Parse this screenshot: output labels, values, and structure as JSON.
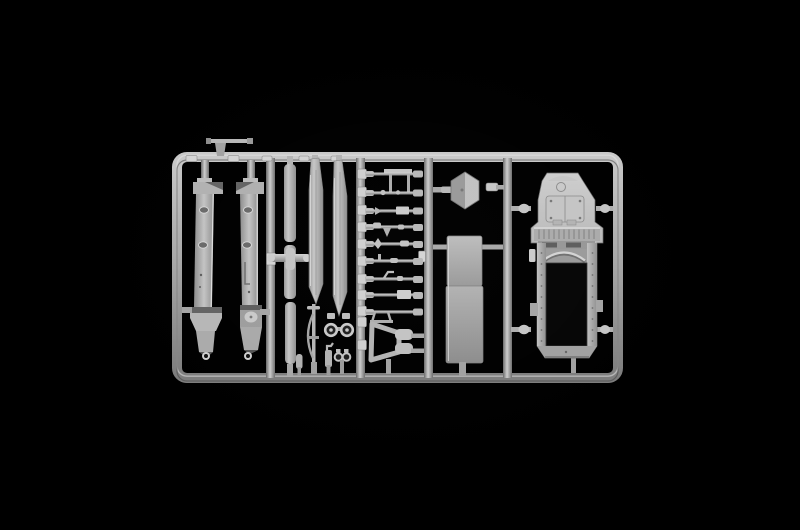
{
  "scene": {
    "type": "photograph",
    "subject": "Light gray injection-molded plastic model kit sprue (parts tree) for a military truck, photographed on a black background",
    "background": "#000000",
    "colors": {
      "plastic-light": "#d8d8d8",
      "plastic-mid": "#a9a9a9",
      "plastic-dark": "#6f6f6f",
      "plastic-shadow": "#4e4e4e",
      "hole": "#060606"
    }
  },
  "sprue": {
    "frame": "rounded rectangular outer runner with four internal vertical runners and molded part-number tabs",
    "parts": [
      {
        "id": "chassis-rail-left",
        "desc": "long chassis side rail with two oval lightening holes and fender foot"
      },
      {
        "id": "chassis-rail-right",
        "desc": "long chassis side rail with filler block, round cap and fender foot"
      },
      {
        "id": "exhaust-pipe",
        "desc": "three-segment tubular exhaust with center collar and crossbar"
      },
      {
        "id": "bed-panel-left",
        "desc": "long tapered side panel"
      },
      {
        "id": "bed-panel-right",
        "desc": "long tapered side panel"
      },
      {
        "id": "bow-stand",
        "desc": "thin lever with bowed brace"
      },
      {
        "id": "steering-wheels",
        "desc": "pair of small wheels with hubs"
      },
      {
        "id": "small-fittings",
        "desc": "row of small cylinders, pump and twin rollers"
      },
      {
        "id": "linkage-set",
        "desc": "nine small axle and steering linkage rods"
      },
      {
        "id": "tow-frame",
        "desc": "trapezoidal sub-frame with twin cylinders"
      },
      {
        "id": "hex-tank-cap",
        "desc": "hexagonal tank part"
      },
      {
        "id": "floor-panel-upper",
        "desc": "rectangular floor panel"
      },
      {
        "id": "floor-panel-lower",
        "desc": "rectangular floor panel"
      },
      {
        "id": "cab-shell",
        "desc": "armored cab and bonnet shell with louvres, windscreen arch and open roof"
      },
      {
        "id": "lever-bar",
        "desc": "small T-bar part above the frame"
      }
    ]
  }
}
